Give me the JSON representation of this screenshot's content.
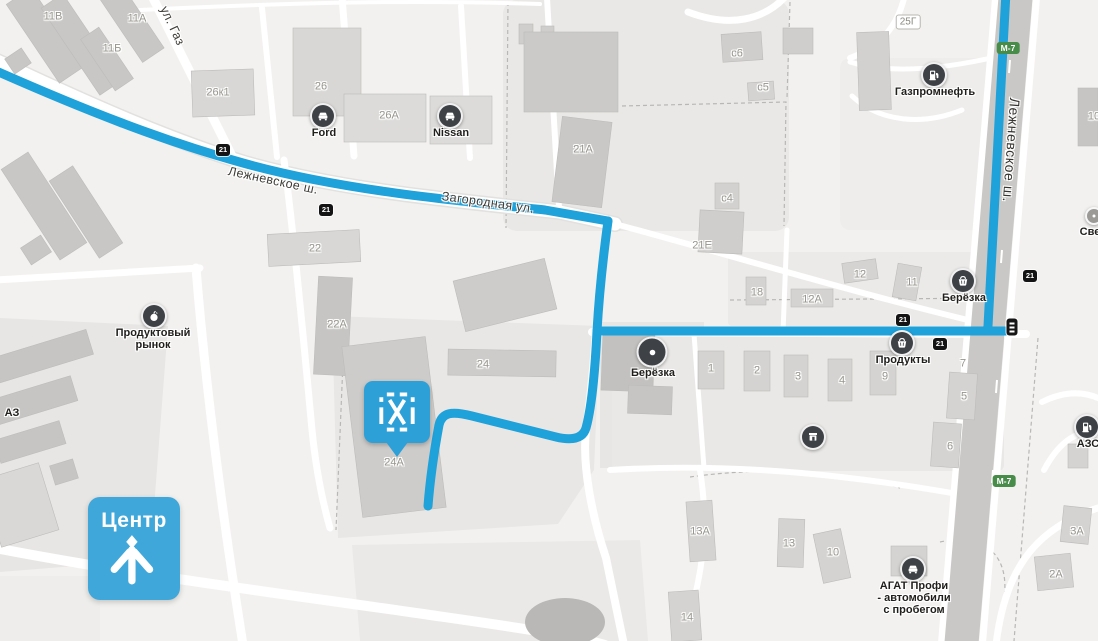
{
  "map": {
    "colors": {
      "route": "#1fa1da",
      "marker": "#2ea0d8",
      "center_badge": "#3fa7d9",
      "road_sign_bg": "#141414",
      "highway_badge_bg": "#478c49",
      "poi_icon_bg": "#3e4247"
    },
    "street_labels": [
      {
        "name": "street-lezhnevskoe-west",
        "text": "Лежневское ш.",
        "x": 273,
        "y": 181,
        "rot": 12,
        "cls": "street"
      },
      {
        "name": "street-zagorodnaya",
        "text": "Загородная ул.",
        "x": 488,
        "y": 203,
        "rot": 8,
        "cls": "street"
      },
      {
        "name": "street-lezhnevskoe-east",
        "text": "Лежневское ш.",
        "x": 1011,
        "y": 150,
        "rot": 94,
        "cls": "street-big"
      },
      {
        "name": "street-ul-gaz",
        "text": "ул. Газ",
        "x": 172,
        "y": 26,
        "rot": 65,
        "cls": "street"
      }
    ],
    "building_labels": [
      {
        "text": "11В",
        "x": 53,
        "y": 17
      },
      {
        "text": "11А",
        "x": 137,
        "y": 19
      },
      {
        "text": "11Б",
        "x": 112,
        "y": 49
      },
      {
        "text": "26к1",
        "x": 218,
        "y": 93
      },
      {
        "text": "26",
        "x": 321,
        "y": 87
      },
      {
        "text": "26А",
        "x": 389,
        "y": 116
      },
      {
        "text": "с6",
        "x": 737,
        "y": 54
      },
      {
        "text": "с5",
        "x": 763,
        "y": 88
      },
      {
        "text": "21А",
        "x": 583,
        "y": 150
      },
      {
        "text": "с4",
        "x": 727,
        "y": 199
      },
      {
        "text": "21Е",
        "x": 702,
        "y": 246
      },
      {
        "text": "22",
        "x": 315,
        "y": 249
      },
      {
        "text": "22А",
        "x": 337,
        "y": 325
      },
      {
        "text": "24",
        "x": 483,
        "y": 365
      },
      {
        "text": "24А",
        "x": 394,
        "y": 463
      },
      {
        "text": "18",
        "x": 757,
        "y": 293
      },
      {
        "text": "12",
        "x": 860,
        "y": 275
      },
      {
        "text": "12А",
        "x": 812,
        "y": 300
      },
      {
        "text": "11",
        "x": 912,
        "y": 283
      },
      {
        "text": "1",
        "x": 711,
        "y": 369
      },
      {
        "text": "2",
        "x": 757,
        "y": 371
      },
      {
        "text": "3",
        "x": 798,
        "y": 377
      },
      {
        "text": "4",
        "x": 842,
        "y": 381
      },
      {
        "text": "9",
        "x": 885,
        "y": 377
      },
      {
        "text": "7",
        "x": 963,
        "y": 364
      },
      {
        "text": "5",
        "x": 964,
        "y": 397
      },
      {
        "text": "6",
        "x": 950,
        "y": 447
      },
      {
        "text": "13А",
        "x": 700,
        "y": 532
      },
      {
        "text": "13",
        "x": 789,
        "y": 544
      },
      {
        "text": "10",
        "x": 833,
        "y": 553
      },
      {
        "text": "14",
        "x": 687,
        "y": 618
      },
      {
        "text": "3А",
        "x": 1077,
        "y": 532
      },
      {
        "text": "2А",
        "x": 1056,
        "y": 575
      },
      {
        "text": "10",
        "x": 1094,
        "y": 117
      }
    ],
    "bordered_labels": [
      {
        "name": "building-label-25g",
        "text": "25Г",
        "x": 908,
        "y": 22
      }
    ],
    "edge_labels": [
      {
        "name": "edge-label-az",
        "text": "АЗ",
        "x": 12,
        "y": 413,
        "cls": "poi-label"
      },
      {
        "name": "edge-label-sve",
        "text": "Све",
        "x": 1090,
        "y": 232,
        "cls": "poi-label"
      }
    ],
    "road_signs": [
      {
        "text": "21",
        "x": 223,
        "y": 150
      },
      {
        "text": "21",
        "x": 326,
        "y": 210
      },
      {
        "text": "21",
        "x": 903,
        "y": 320
      },
      {
        "text": "21",
        "x": 940,
        "y": 344
      },
      {
        "text": "21",
        "x": 1030,
        "y": 276
      }
    ],
    "highway_badges": [
      {
        "text": "М-7",
        "x": 1008,
        "y": 48
      },
      {
        "text": "М-7",
        "x": 1004,
        "y": 481
      }
    ],
    "transit_stop": {
      "x": 1012,
      "y": 327
    },
    "pois": [
      {
        "name": "ford-poi",
        "icon": "car-icon",
        "lines": [
          "Ford"
        ],
        "x": 323,
        "y": 116
      },
      {
        "name": "nissan-poi",
        "icon": "car-icon",
        "lines": [
          "Nissan"
        ],
        "x": 450,
        "y": 116
      },
      {
        "name": "gazpromneft-poi",
        "icon": "fuel-icon",
        "lines": [
          "Газпромнефть"
        ],
        "x": 934,
        "y": 75
      },
      {
        "name": "berezka-east-poi",
        "icon": "basket-icon",
        "lines": [
          "Берёзка"
        ],
        "x": 963,
        "y": 281
      },
      {
        "name": "produkty-poi",
        "icon": "basket-icon",
        "lines": [
          "Продукты"
        ],
        "x": 902,
        "y": 343
      },
      {
        "name": "berezka-center-poi",
        "icon": "circle-dot-icon",
        "lines": [
          "Берёзка"
        ],
        "x": 652,
        "y": 352,
        "big": true
      },
      {
        "name": "produktovy-rynok-poi",
        "icon": "apple-icon",
        "lines": [
          "Продуктовый",
          "рынок"
        ],
        "x": 154,
        "y": 316
      },
      {
        "name": "agat-profi-poi",
        "icon": "car-icon",
        "lines": [
          "АГАТ Профи",
          "- автомобили",
          "с пробегом"
        ],
        "x": 913,
        "y": 569
      },
      {
        "name": "azs-poi",
        "icon": "fuel-icon",
        "lines": [
          "АЗС"
        ],
        "x": 1087,
        "y": 427
      },
      {
        "name": "kiosk-poi",
        "icon": "shop-icon",
        "lines": [],
        "x": 813,
        "y": 437
      },
      {
        "name": "edge-poi-pin",
        "icon": "pin-icon",
        "lines": [],
        "x": 1094,
        "y": 216
      }
    ],
    "marker": {
      "name": "destination-marker",
      "icon": "ixi-pattern-icon",
      "x": 397,
      "y": 381
    },
    "center_badge": {
      "text": "Центр",
      "x": 88,
      "y": 497,
      "w": 92,
      "h": 91
    }
  }
}
